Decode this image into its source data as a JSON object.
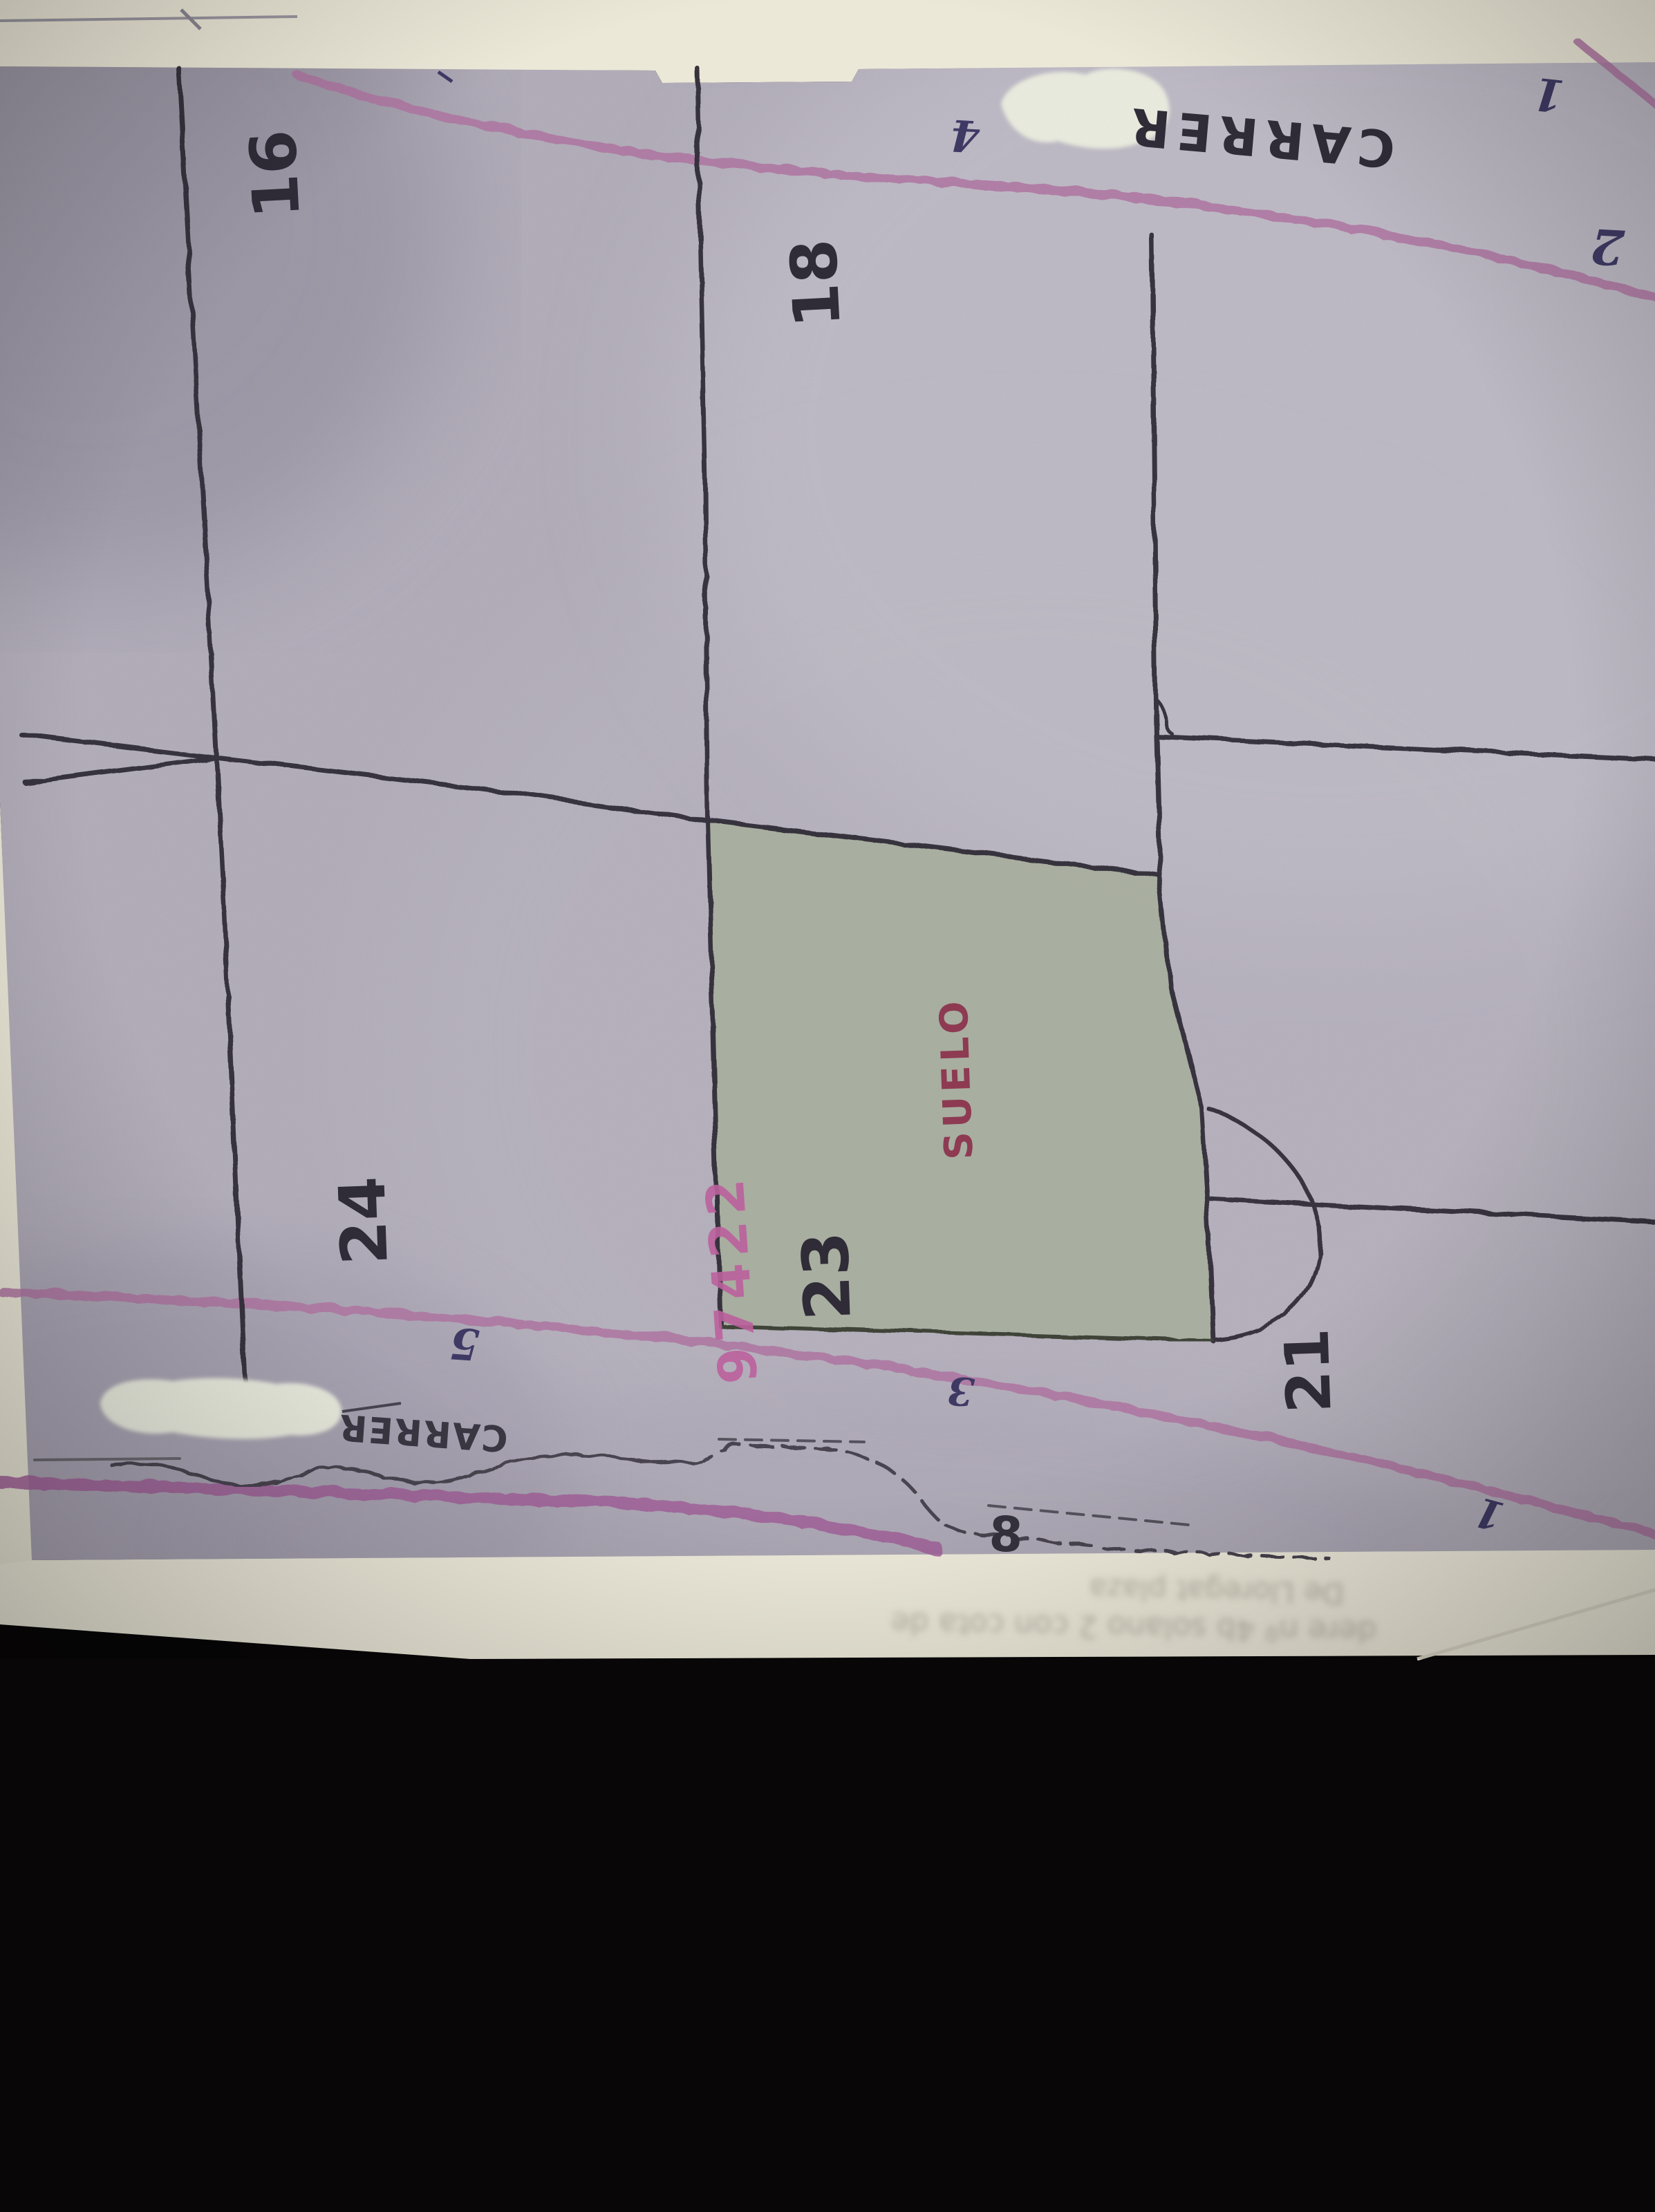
{
  "photo": {
    "description": "Photograph of a printed cadastral plan on lavender paper over a black background",
    "colors": {
      "paper": "#b4afbb",
      "scanner_margin": "#ece8d8",
      "background": "#080607",
      "boundary_ink": "#2e2a35",
      "road_ink": "#b175a3",
      "suelo_parcel_fill": "#aab19e",
      "suelo_text": "#8f3850",
      "reference_text": "#c0619f",
      "handwriting_ink": "#3c3763"
    }
  },
  "map": {
    "street_top": "CARRER",
    "street_left": "CARRER",
    "land_use_label": "SUELO",
    "reference_code": "97422",
    "parcels": {
      "p16": "16",
      "p18": "18",
      "p24": "24",
      "p23": "23",
      "p21": "21"
    },
    "house_numbers": {
      "top_4": "4",
      "top_right_1": "1",
      "right_2": "2",
      "left_5": "5",
      "bottom_3": "3",
      "bottom_8": "8",
      "bottom_right_1": "1"
    },
    "bleed_through": {
      "line1": "De Lloregat  plaza",
      "line2": "dere nº 4b solano 2 con cota de"
    }
  }
}
